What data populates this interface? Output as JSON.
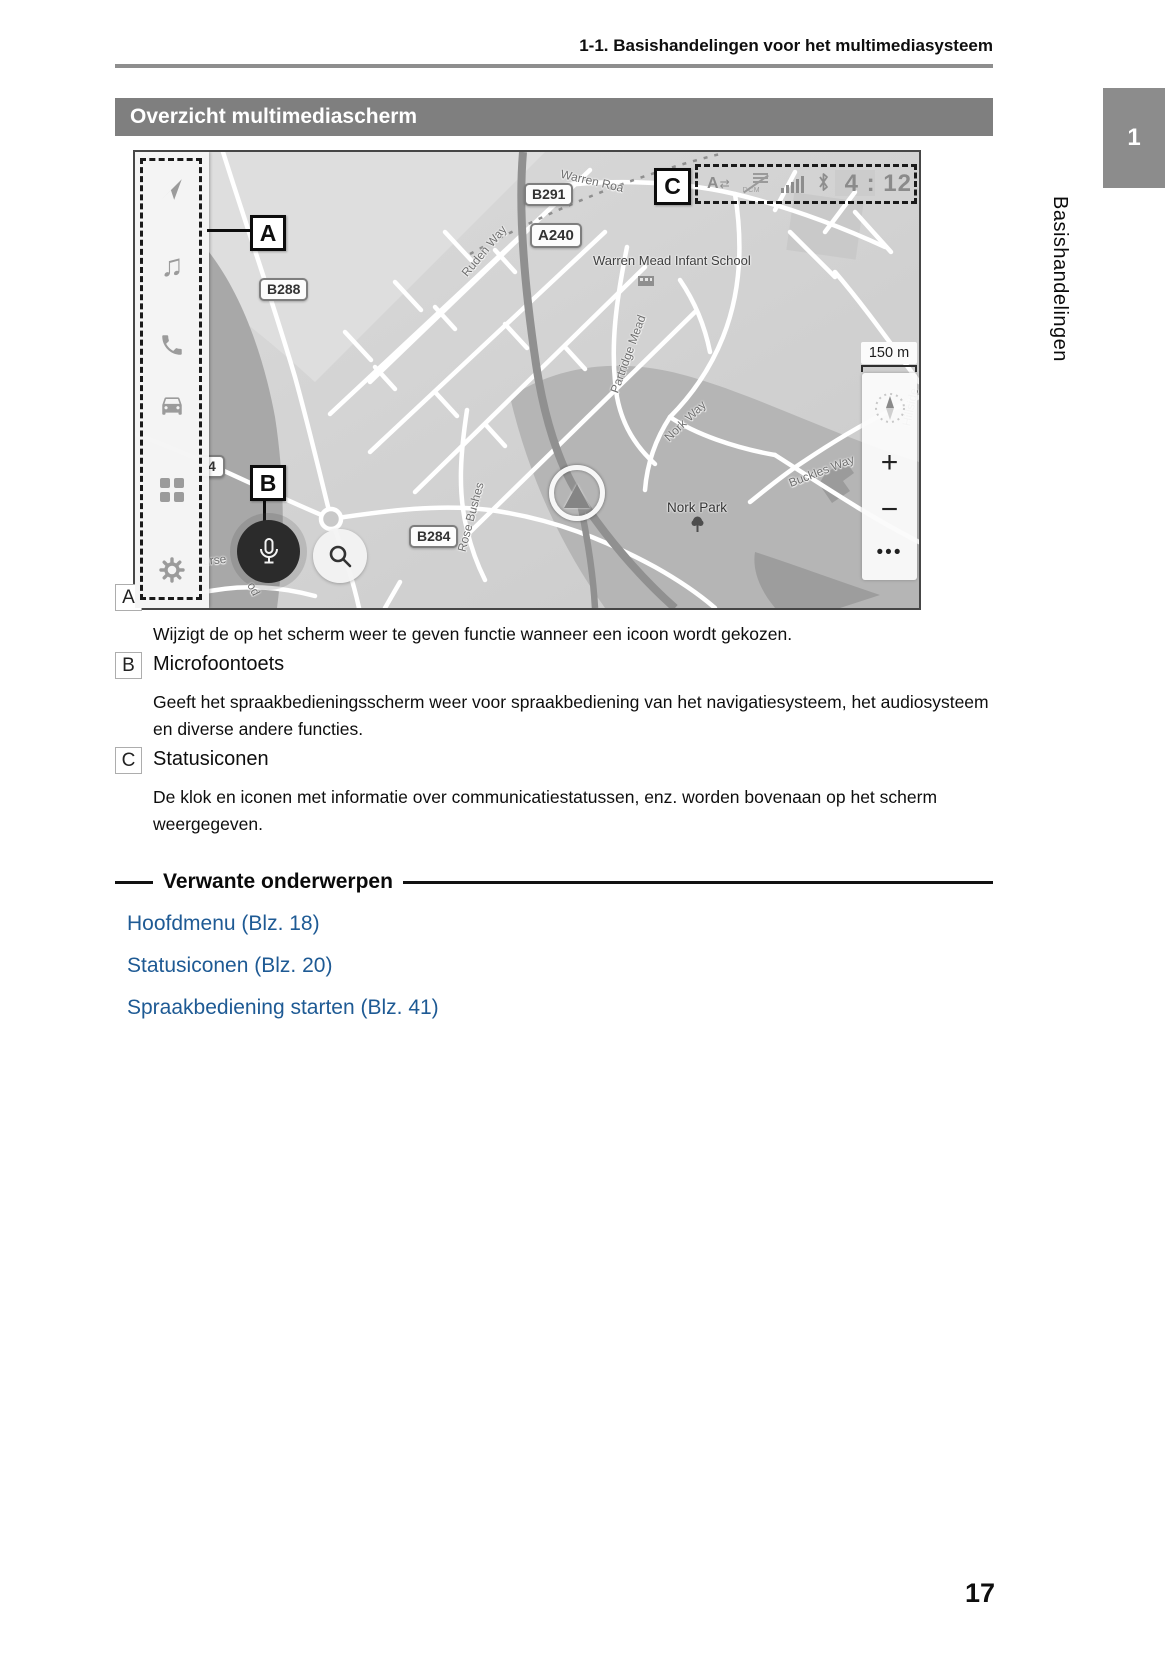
{
  "page": {
    "header": "1-1. Basishandelingen voor het multimediasysteem",
    "section_title": "Overzicht multimediascherm",
    "chapter_tab": "1",
    "chapter_side_label": "Basishandelingen",
    "page_number": "17"
  },
  "map": {
    "callouts": {
      "a": "A",
      "b": "B",
      "c": "C"
    },
    "status": {
      "voice_letter": "A",
      "voice_arrows": "⇄",
      "dcm": "DCM",
      "time": "4 : 12",
      "icons": [
        "voice-recognition-icon",
        "dcm-off-icon",
        "signal-strength-icon",
        "bluetooth-icon"
      ]
    },
    "sidebar_icons": [
      "navigation",
      "media",
      "phone",
      "car",
      "apps",
      "settings"
    ],
    "glyphs": {
      "music": "♫"
    },
    "badges": [
      {
        "label": "B291"
      },
      {
        "label": "A240"
      },
      {
        "label": "B288"
      },
      {
        "label": "B284"
      },
      {
        "label": "4"
      }
    ],
    "streets": [
      "Warren Roa",
      "Ruden Way",
      "Partridge Mead",
      "Nork Way",
      "Buckles Way",
      "Rose Bushes",
      "Hillside",
      "urse",
      "od"
    ],
    "poi": {
      "school": "Warren Mead Infant School",
      "park": "Nork Park"
    },
    "scale": "150 m",
    "controls": {
      "zoom_in": "+",
      "zoom_out": "−",
      "more": "•••"
    }
  },
  "legend": [
    {
      "key": "A",
      "title": "Hoofdmenu",
      "desc": "Wijzigt de op het scherm weer te geven functie wanneer een icoon wordt gekozen."
    },
    {
      "key": "B",
      "title": "Microfoontoets",
      "desc": "Geeft het spraakbedieningsscherm weer voor spraakbediening van het navigatiesysteem, het audiosysteem en diverse andere functies."
    },
    {
      "key": "C",
      "title": "Statusiconen",
      "desc": "De klok en iconen met informatie over communicatiestatussen, enz. worden bovenaan op het scherm weergegeven."
    }
  ],
  "related": {
    "heading": "Verwante onderwerpen",
    "links": [
      "Hoofdmenu (Blz. 18)",
      "Statusiconen (Blz. 20)",
      "Spraakbediening starten (Blz. 41)"
    ]
  },
  "colors": {
    "link": "#1e5a94",
    "title_bar_bg": "#7f7f7f",
    "chapter_tab_bg": "#8c8c8c",
    "map_base": "#d2d2d2",
    "park": "#b5b5b5",
    "status_gray": "#8d8d8d"
  }
}
